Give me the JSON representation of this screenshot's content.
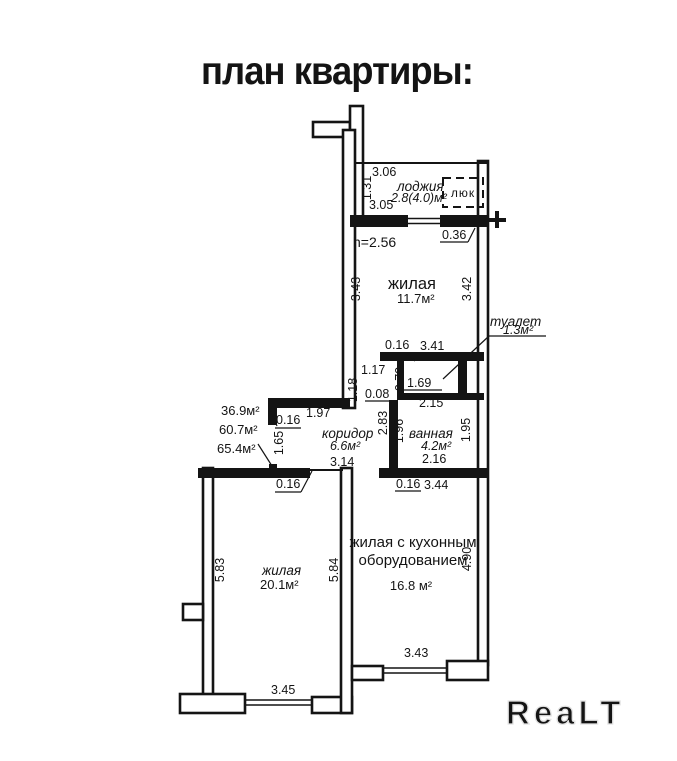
{
  "title": "план квартиры:",
  "watermark": "ReaLT",
  "rooms": {
    "loggia": {
      "name": "лоджия",
      "area": "2.8(4.0)м²",
      "hatch": "люк"
    },
    "living_top": {
      "name": "жилая",
      "area": "11.7м²"
    },
    "toilet": {
      "name": "туалет",
      "area": "1.3м²"
    },
    "bathroom": {
      "name": "ванная",
      "area": "4.2м²"
    },
    "corridor": {
      "name": "коридор",
      "area": "6.6м²"
    },
    "living_left": {
      "name": "жилая",
      "area": "20.1м²"
    },
    "living_kitchen": {
      "name_line1": "жилая с кухонным",
      "name_line2": "оборудованием",
      "area": "16.8 м²"
    }
  },
  "summary": {
    "living": "36.9м²",
    "total": "60.7м²",
    "full": "65.4м²"
  },
  "ceiling_height": "h=2.56",
  "dims": {
    "loggia_top": "3.06",
    "loggia_side": "1.31",
    "loggia_bottom": "3.05",
    "balcony_door": "0.36",
    "living_top_left": "3.43",
    "living_top_right": "3.42",
    "wall_t1": "0.16",
    "toilet_wall": "3.41",
    "passage": "1.17",
    "passage_side": "1.18",
    "toilet_depth": "0.79",
    "toilet_width": "1.69",
    "step": "0.08",
    "bath_top": "2.15",
    "corridor_arm": "2.83",
    "bath_left": "1.96",
    "bath_right": "1.95",
    "bath_bottom": "2.16",
    "wall_t2": "0.16",
    "bath_wall": "3.44",
    "hall_wall": "1.97",
    "wall_t3": "0.16",
    "hall_side": "1.65",
    "corridor_len": "3.14",
    "wall_t4": "0.16",
    "room1_left": "5.83",
    "room1_right": "5.84",
    "room1_bottom": "3.45",
    "room2_right": "4.90",
    "room2_bottom": "3.43"
  }
}
